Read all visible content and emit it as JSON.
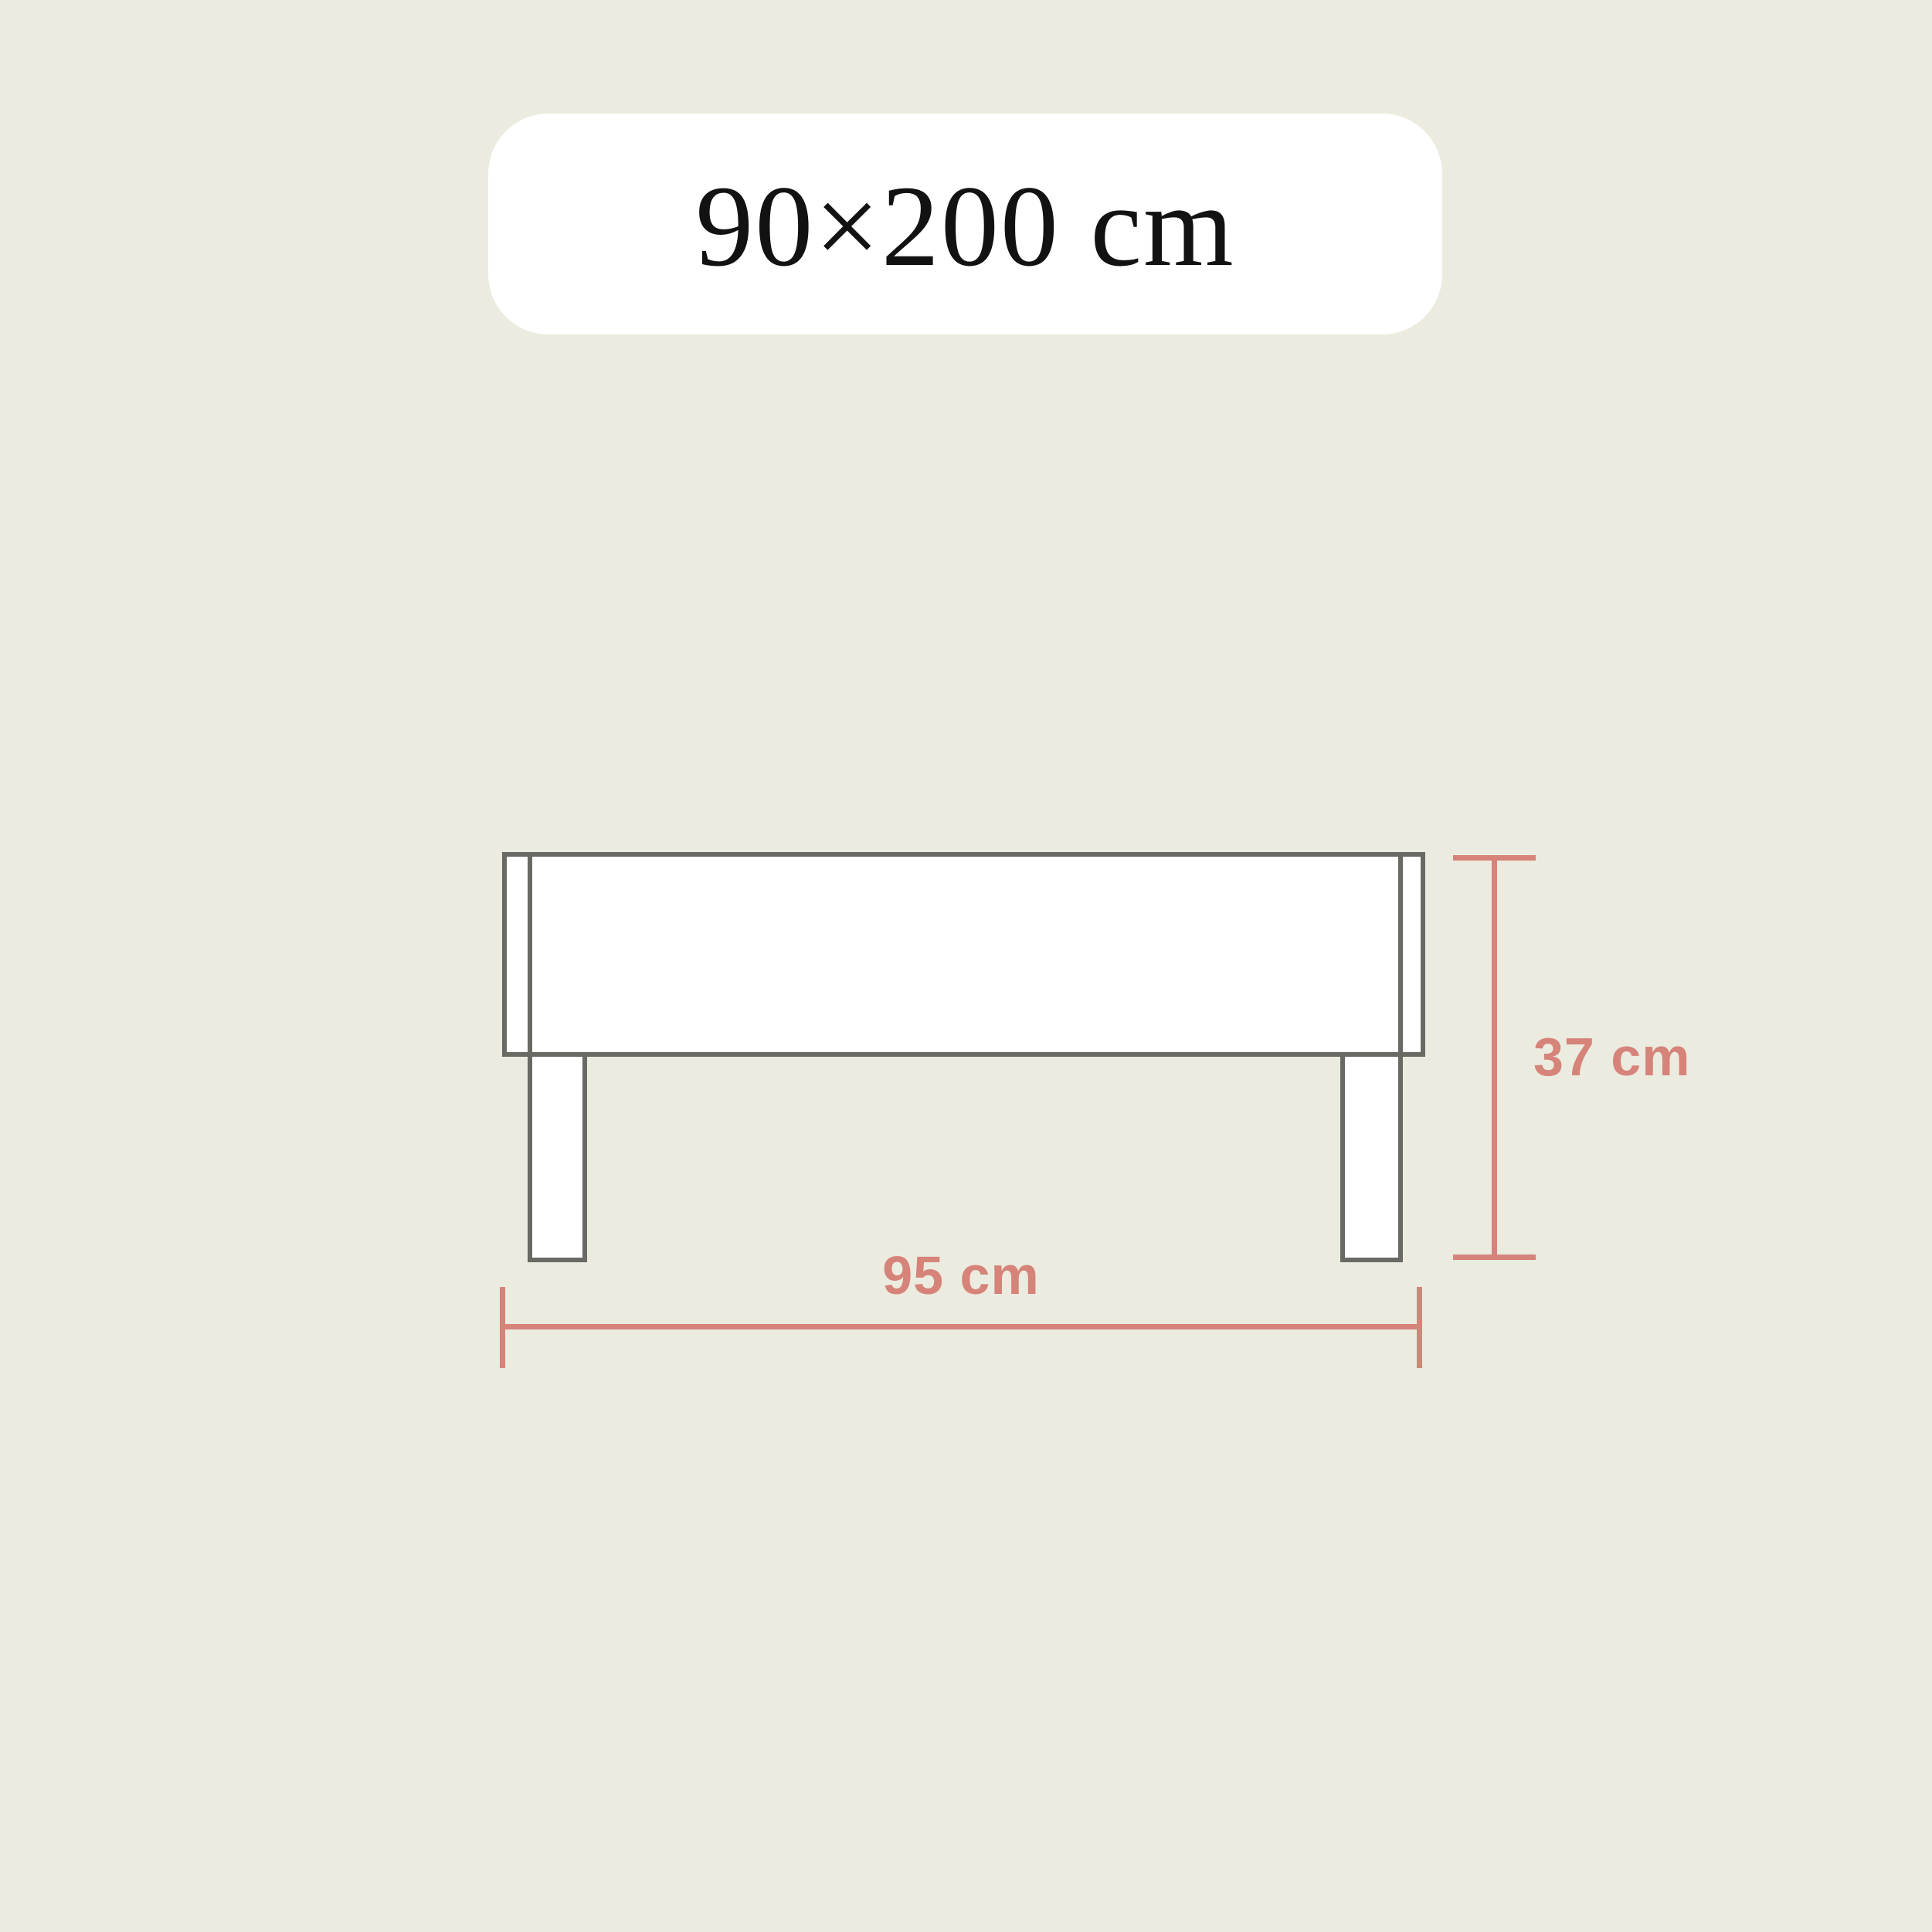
{
  "header": {
    "title": "90×200 cm"
  },
  "diagram": {
    "subject": "bed-frame-front-view",
    "dimensions": {
      "height": {
        "label": "37 cm",
        "value": 37,
        "unit": "cm"
      },
      "width": {
        "label": "95 cm",
        "value": 95,
        "unit": "cm"
      }
    }
  },
  "colors": {
    "background": "#EBEBDF",
    "surface": "#FFFFFF",
    "outline": "#6A6A65",
    "accent": "#D6837A",
    "title-text": "#121212"
  }
}
